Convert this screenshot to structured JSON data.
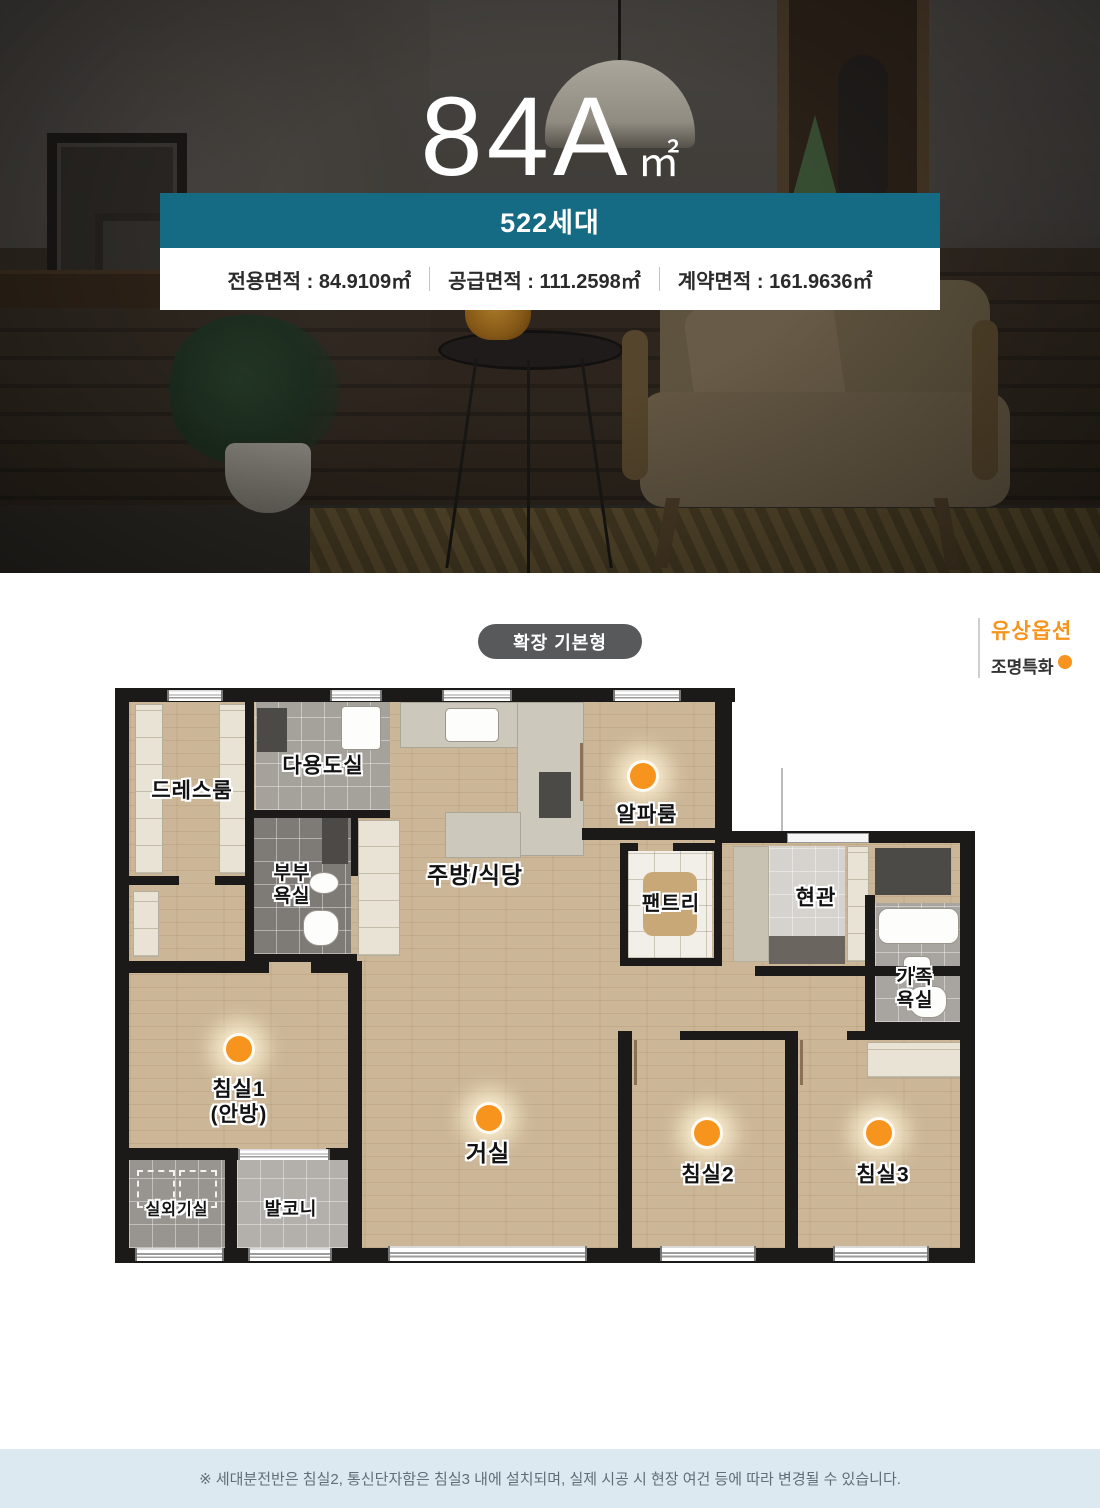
{
  "hero": {
    "title": "84A",
    "title_unit": "㎡",
    "household_badge": "522세대",
    "areas": [
      "전용면적 : 84.9109㎡",
      "공급면적 : 111.2598㎡",
      "계약면적 : 161.9636㎡"
    ]
  },
  "plan": {
    "type_badge": "확장 기본형",
    "legend": {
      "title": "유상옵션",
      "item": "조명특화"
    },
    "colors": {
      "accent_orange": "#f7941d",
      "teal": "#166b84"
    }
  },
  "floorplan": {
    "rooms": {
      "dressroom": "드레스룸",
      "utility": "다용도실",
      "couple_bath": "부부\n욕실",
      "kitchen": "주방/식당",
      "alpha": "알파룸",
      "pantry": "팬트리",
      "entrance": "현관",
      "family_bath": "가족\n욕실",
      "bedroom1": "침실1\n(안방)",
      "living": "거실",
      "bedroom2": "침실2",
      "bedroom3": "침실3",
      "ac_room": "실외기실",
      "balcony": "발코니"
    },
    "lighting_option_rooms": [
      "알파룸",
      "침실1(안방)",
      "거실",
      "침실2",
      "침실3"
    ]
  },
  "footer": {
    "note": "※ 세대분전반은 침실2, 통신단자함은 침실3 내에 설치되며, 실제 시공 시 현장 여건 등에 따라 변경될 수 있습니다."
  }
}
